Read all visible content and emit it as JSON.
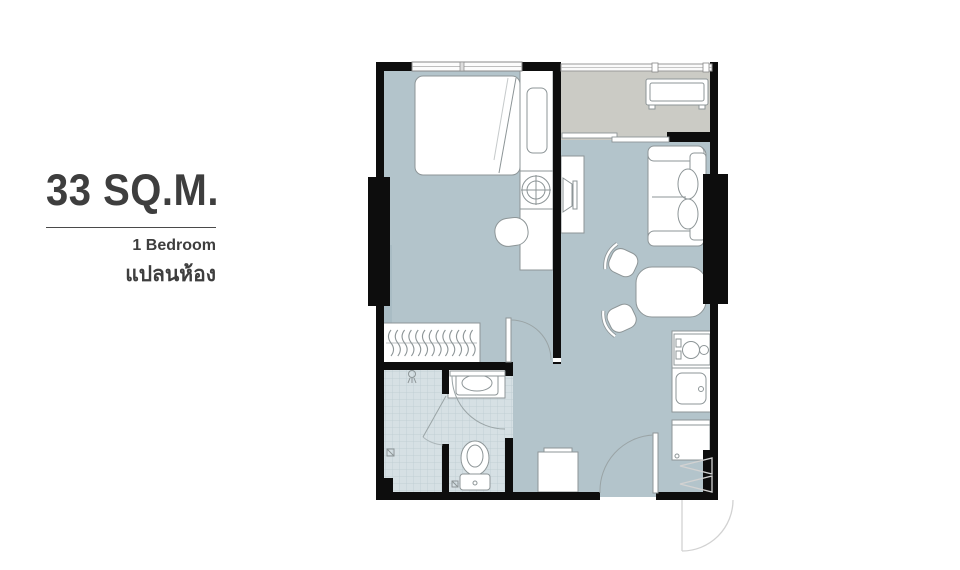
{
  "info_panel": {
    "area": "33 SQ.M.",
    "bedrooms": "1 Bedroom",
    "plan_label_thai": "แปลนห้อง"
  },
  "floor_plan": {
    "rooms": [
      "bedroom",
      "living-dining",
      "kitchen",
      "bathroom",
      "shower",
      "balcony",
      "entry"
    ],
    "furniture": [
      "bed",
      "wardrobe-hangers",
      "wall-cabinet",
      "washing-machine",
      "vanity-stool",
      "tv-stand",
      "sofa",
      "dining-table",
      "dining-chair",
      "dining-chair",
      "stove",
      "kitchen-sink",
      "refrigerator",
      "shoe-cabinet",
      "air-conditioner-unit",
      "toilet",
      "bathroom-sink",
      "shower-head",
      "floor-drain"
    ],
    "colors": {
      "wall": "#0d0d0d",
      "floor": "#b3c4cb",
      "floor_shade": "#a9bcc4",
      "balcony_floor": "#cbcbc5",
      "bathroom_tile": "#d6e0e4",
      "tile_grid": "#bccbd1",
      "furniture_outline": "#8d9597",
      "text": "#3e3e3e"
    }
  }
}
